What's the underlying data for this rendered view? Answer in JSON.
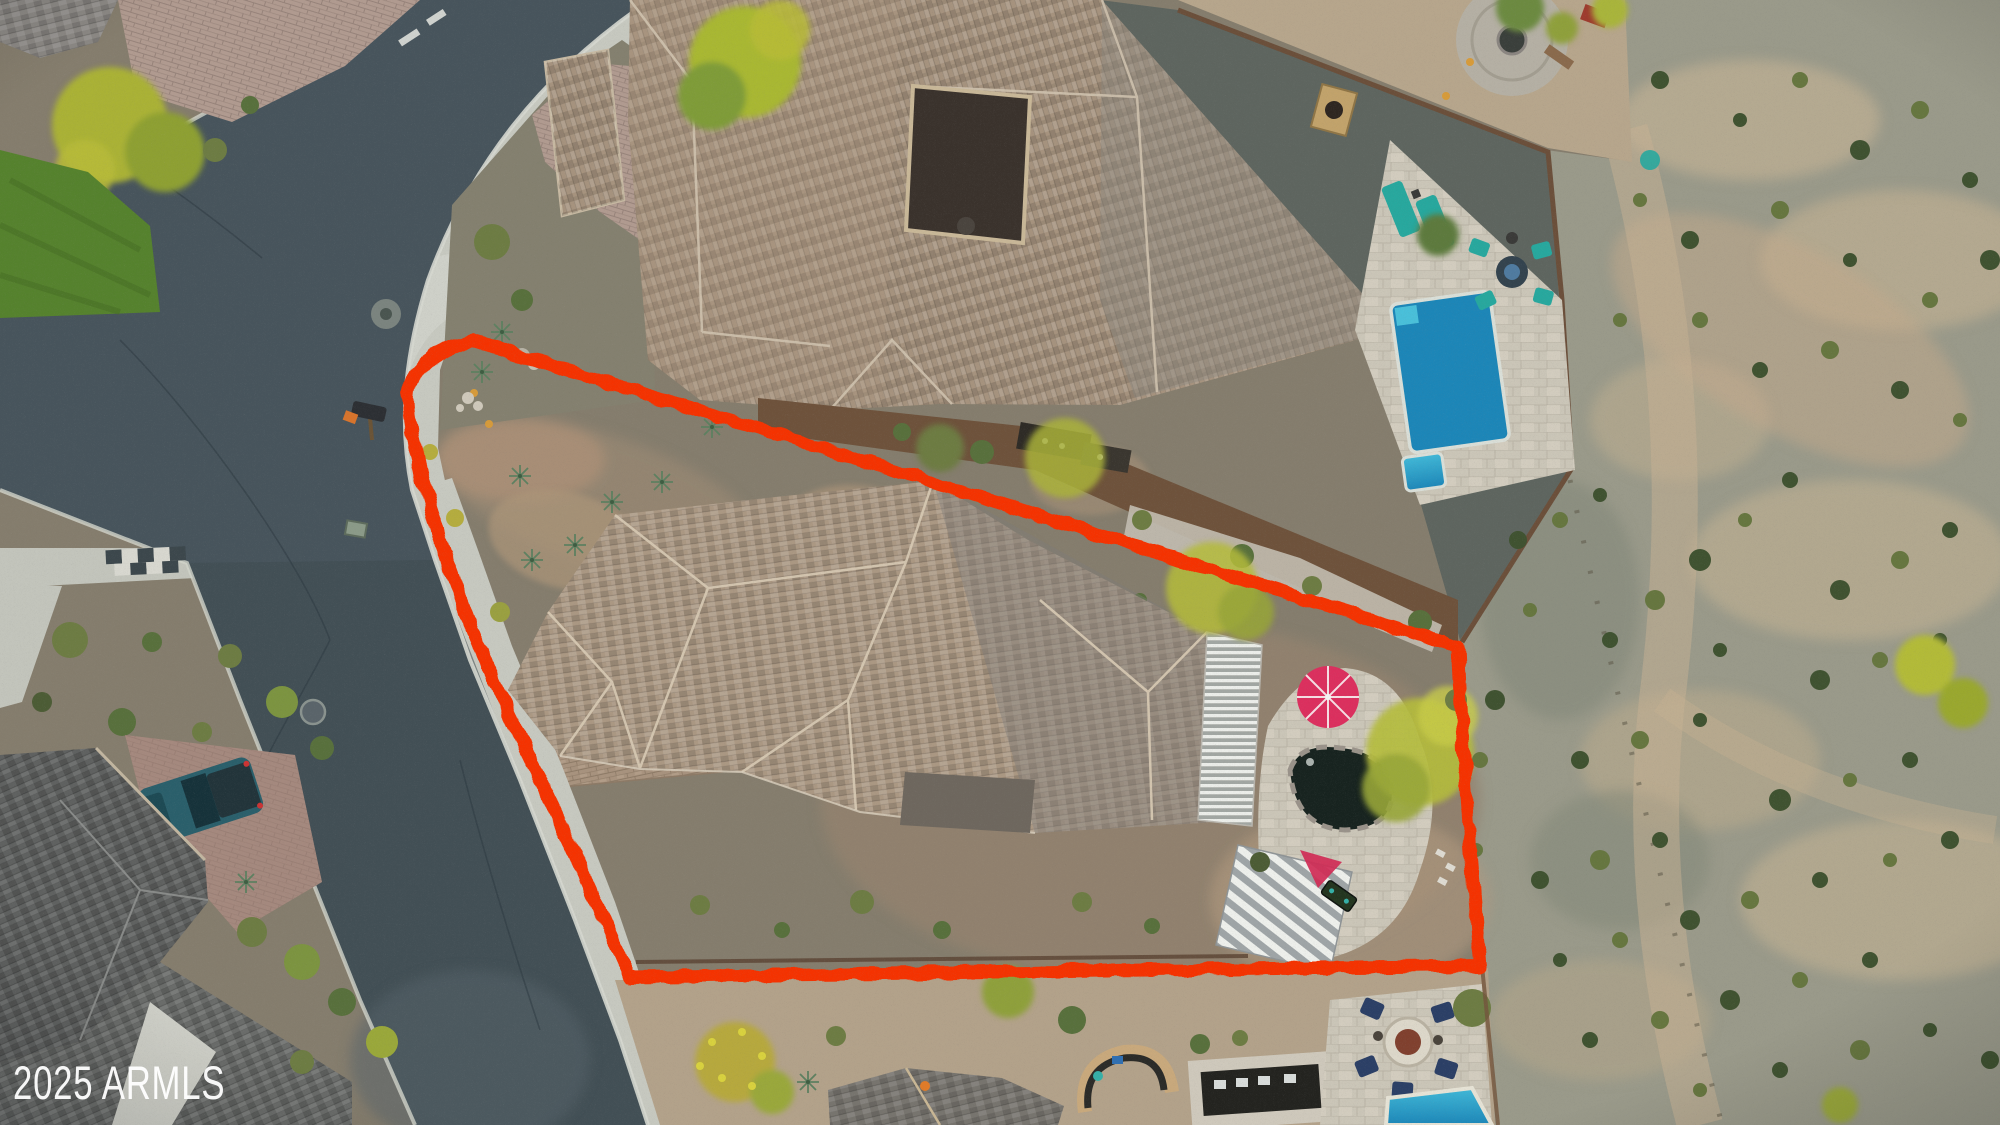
{
  "watermark": {
    "text": "2025 ARMLS",
    "color": "#ffffff"
  },
  "colors": {
    "boundary_red": "#f53305",
    "asphalt": "#47545c",
    "asphalt_dark": "#3e4a51",
    "concrete": "#c7c9c0",
    "gravel_lot": "#7f7868",
    "desert_gray": "#9a9a8a",
    "desert_tan": "#bcae92",
    "pool_blue_light": "#41b9d8",
    "pool_blue_deep": "#1c86b8",
    "teal_furniture": "#27a89e",
    "navy_chair": "#2b3f66",
    "umbrella_pink": "#dc2f5e",
    "grass_green": "#55822d",
    "tree_yellow": "#b5bc3a",
    "truck_teal": "#2a5f6b",
    "firepit_rust": "#80402e"
  },
  "scene": {
    "type": "aerial-drone-photo",
    "subject": "corner residential lot outlined in red marker",
    "landmarks": [
      "curved-street",
      "corner-lot-home",
      "neighbor-home-with-pool",
      "desert-wash",
      "backyard-fire-pit",
      "pickup-truck",
      "white-suv"
    ]
  }
}
